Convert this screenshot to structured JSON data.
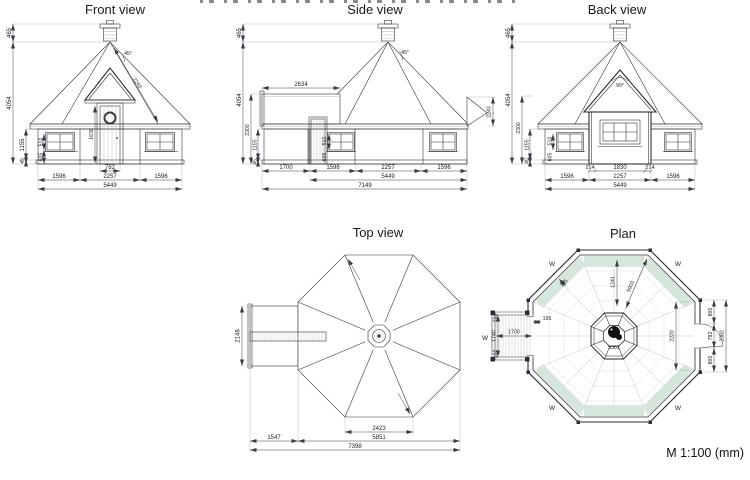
{
  "meta": {
    "scale_note": "M 1:100 (mm)"
  },
  "front": {
    "title": "Front view",
    "chimney_h": "465",
    "total_h": "4054",
    "wall_h": "1155",
    "base_h": "45",
    "win_h": "510",
    "sill_h": "605",
    "door_h": "1630",
    "roof_slope": "2243",
    "roof_angle": "45°",
    "door_w": "782",
    "seg_l": "1596",
    "seg_c": "2257",
    "seg_r": "1596",
    "width": "5449"
  },
  "side": {
    "title": "Side view",
    "chimney_h": "465",
    "total_h": "4054",
    "eave_h": "2300",
    "wall_h": "1155",
    "base_h": "45",
    "porch_roof": "2634",
    "roof_angle": "45°",
    "gable_slope": "2243",
    "win_h": "510",
    "sill_h": "605",
    "porch_len": "1700",
    "seg_l": "1596",
    "seg_c": "2257",
    "seg_r": "1596",
    "body_w": "5449",
    "total_w": "7149"
  },
  "back": {
    "title": "Back view",
    "chimney_h": "465",
    "total_h": "4054",
    "eave_h": "2300",
    "wall_h": "1155",
    "base_h": "45",
    "win_h": "510",
    "sill_h": "605",
    "gable_angle": "90°",
    "jamb_l": "214",
    "opening": "1830",
    "jamb_r": "214",
    "seg_l": "1596",
    "seg_c": "2257",
    "seg_r": "1596",
    "width": "5449"
  },
  "top": {
    "title": "Top view",
    "porch_w": "2148",
    "cap_face": "2423",
    "porch_len": "1547",
    "octagon_w": "5851",
    "total_w": "7398"
  },
  "plan": {
    "title": "Plan",
    "window": "W",
    "porch_end_top": "160",
    "porch_w": "1740",
    "porch_end_bot": "160",
    "porch_len": "1700",
    "wall_t": "195",
    "wall_t2": "195",
    "to_table": "1241",
    "diagonal": "5903",
    "interior": "2220",
    "table": "5361",
    "door_top": "800",
    "door_w": "782",
    "door_bot": "800",
    "door_total": "2382"
  }
}
